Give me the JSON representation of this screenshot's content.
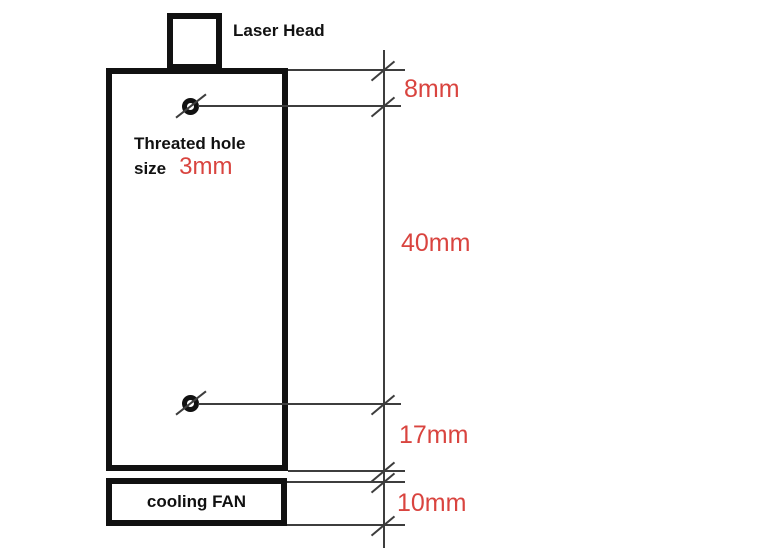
{
  "diagram": {
    "labels": {
      "laser_head": "Laser Head",
      "threaded_hole_line1": "Threated hole",
      "threaded_hole_line2": "size",
      "threaded_hole_size": "3mm",
      "cooling_fan": "cooling FAN"
    },
    "dimensions": {
      "top_offset": "8mm",
      "hole_spacing": "40mm",
      "bottom_offset": "17mm",
      "fan_height": "10mm"
    },
    "colors": {
      "outline": "#111111",
      "line": "#3d3d3d",
      "dimension_text": "#d9443f",
      "label_text": "#111111",
      "background": "#ffffff"
    }
  }
}
